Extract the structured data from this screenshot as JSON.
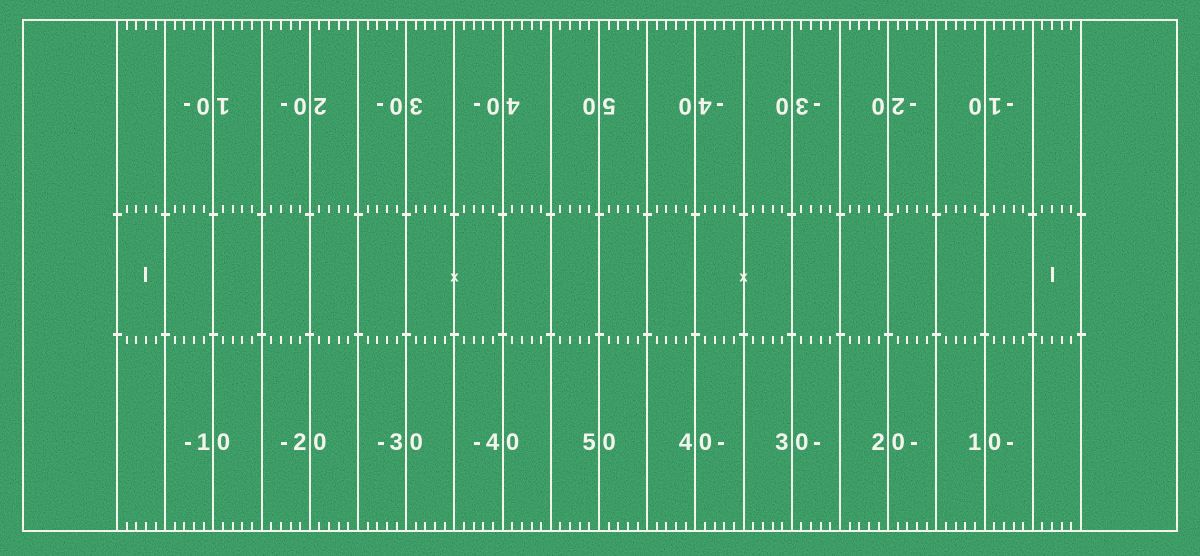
{
  "field": {
    "description": "American football field top-down diagram",
    "grass_color": "#2e9056",
    "line_color": "#f2f4ec",
    "length_yards": 100,
    "endzone_depth_yards": 10,
    "yard_line_interval_yards": 5,
    "tick_interval_yards": 1,
    "numbers": [
      {
        "yd": 10,
        "label": "10",
        "arrow": "left"
      },
      {
        "yd": 20,
        "label": "20",
        "arrow": "left"
      },
      {
        "yd": 30,
        "label": "30",
        "arrow": "left"
      },
      {
        "yd": 40,
        "label": "40",
        "arrow": "left"
      },
      {
        "yd": 50,
        "label": "50",
        "arrow": null
      },
      {
        "yd": 60,
        "label": "40",
        "arrow": "right"
      },
      {
        "yd": 70,
        "label": "30",
        "arrow": "right"
      },
      {
        "yd": 80,
        "label": "20",
        "arrow": "right"
      },
      {
        "yd": 90,
        "label": "10",
        "arrow": "right"
      }
    ],
    "number_rows": [
      {
        "name": "top",
        "y_px": 105,
        "rotated": true
      },
      {
        "name": "bottom",
        "y_px": 443,
        "rotated": false
      }
    ],
    "marks": {
      "kickoff_x": {
        "glyph": "x",
        "yards": [
          35,
          65
        ]
      },
      "conversion_dash": {
        "yards": [
          3,
          97
        ]
      }
    }
  }
}
